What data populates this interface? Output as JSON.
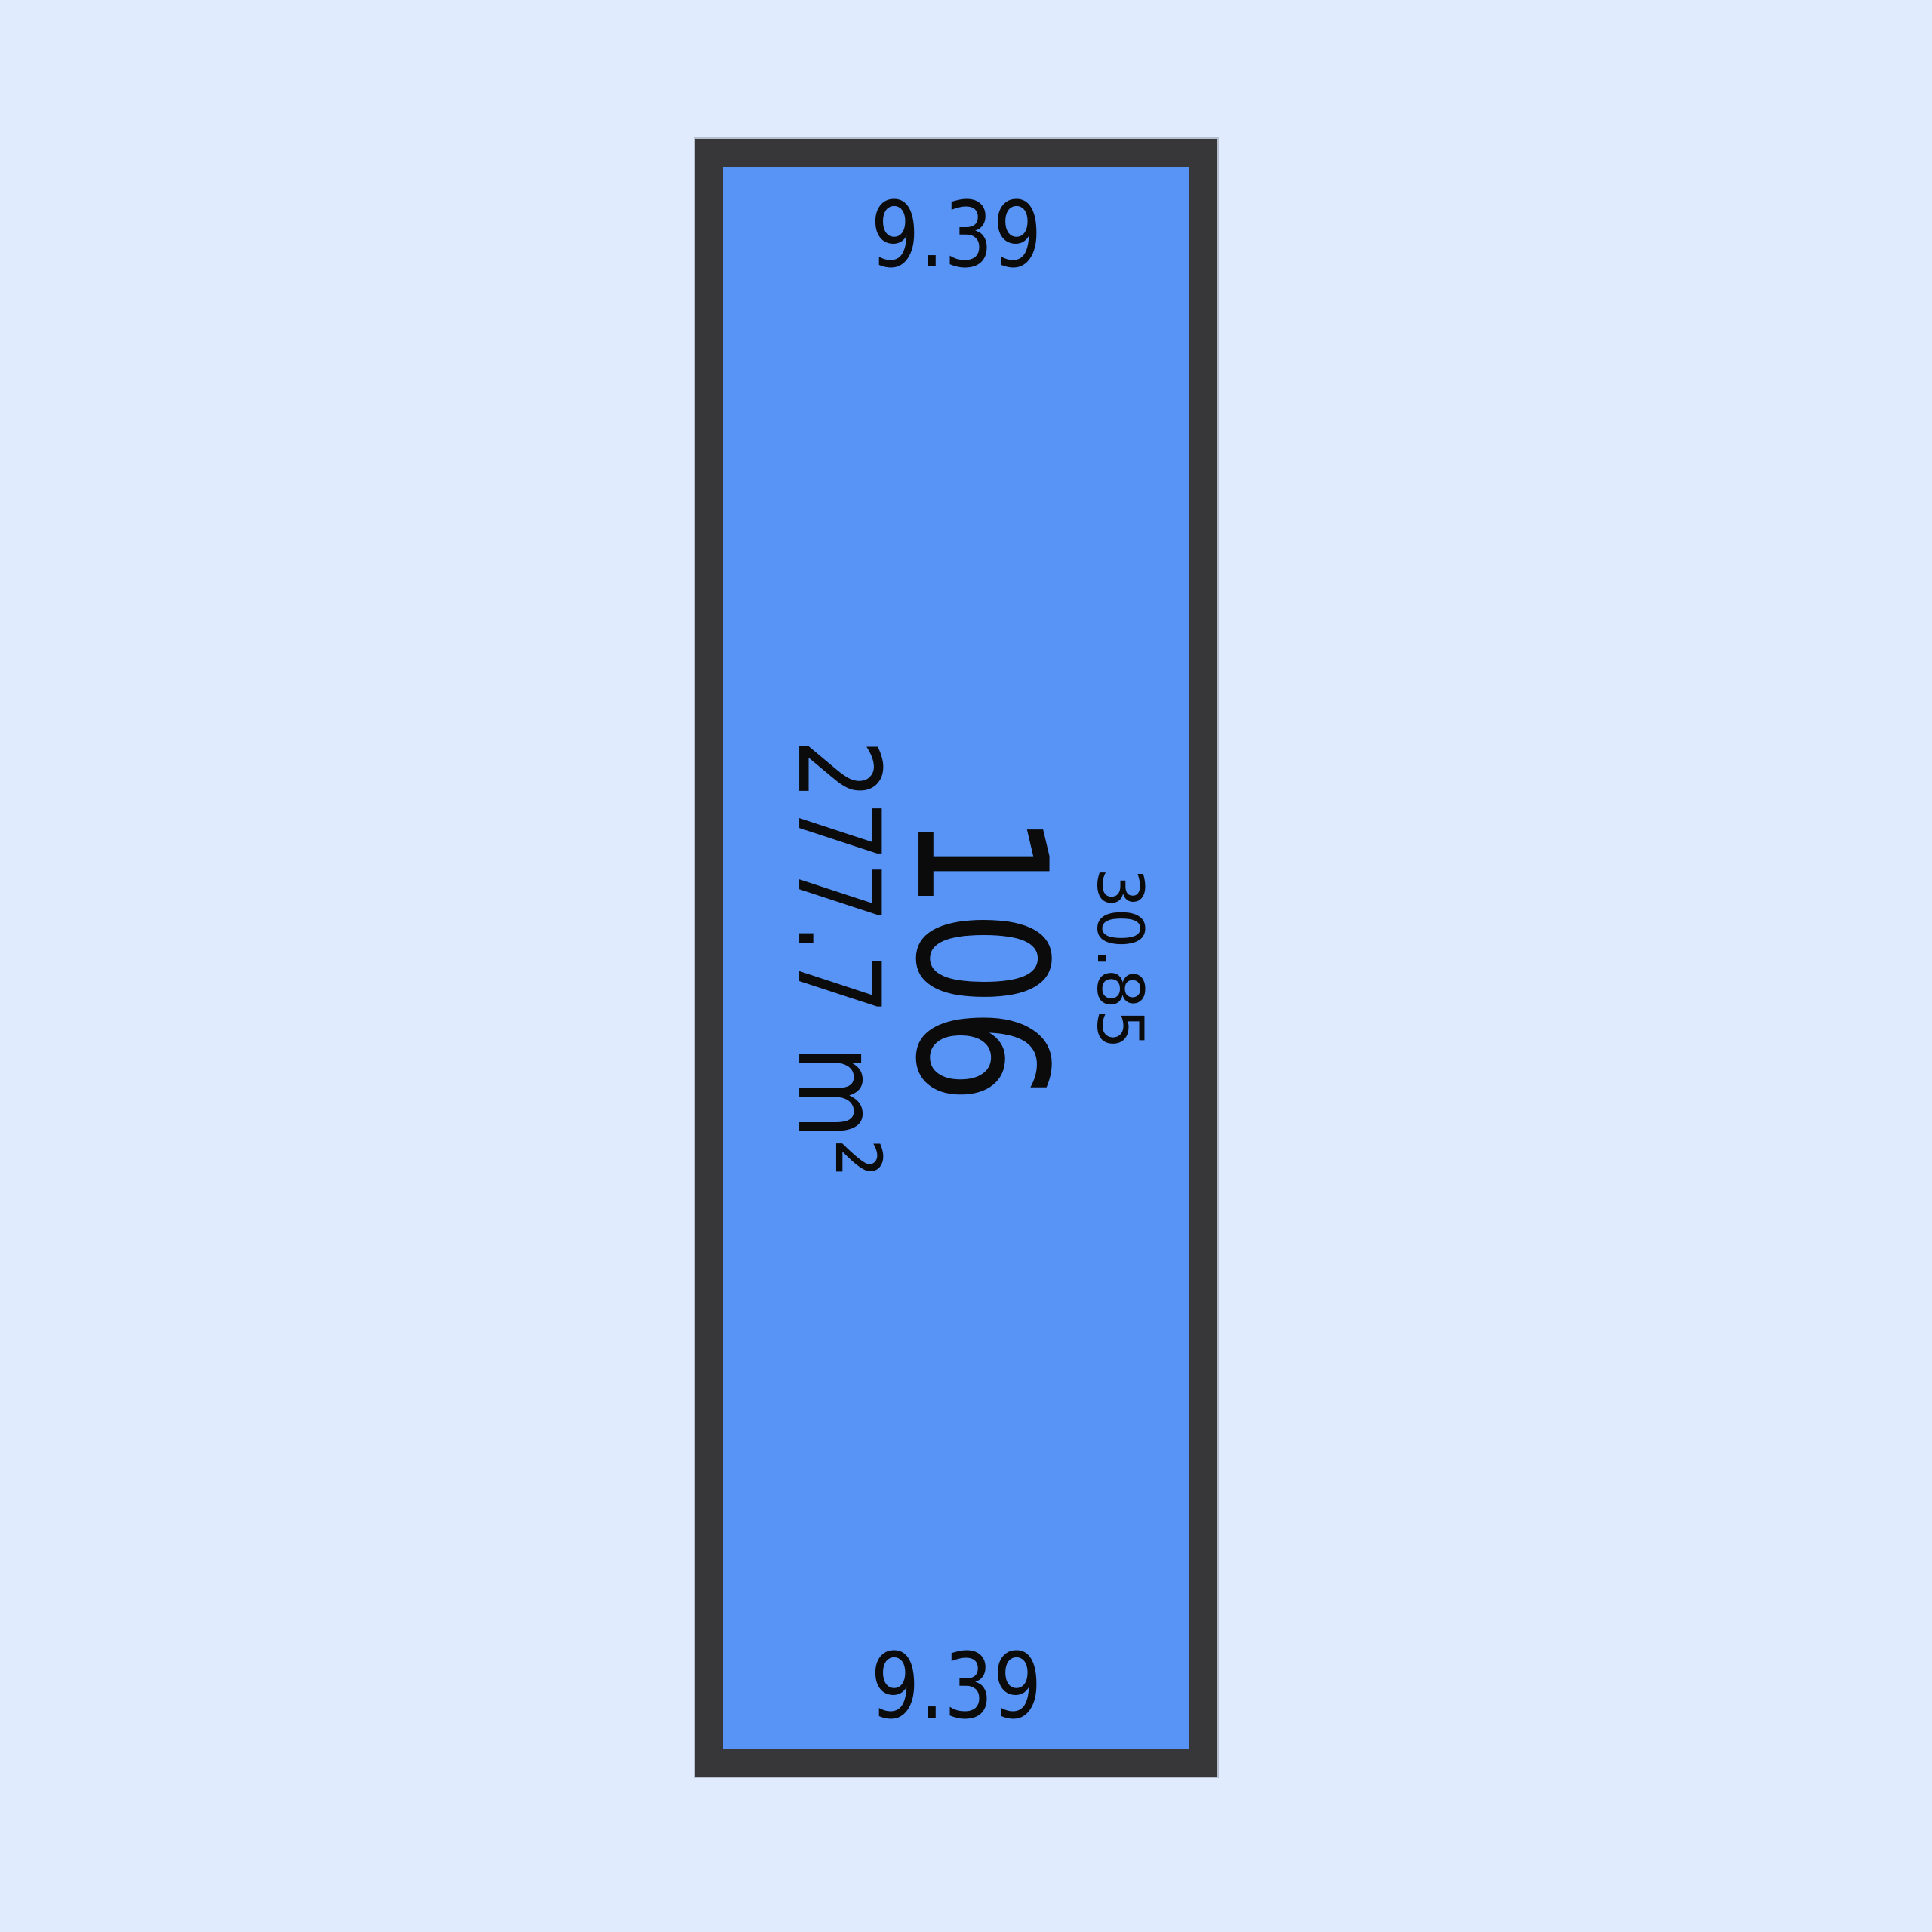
{
  "page": {
    "background_color": "#e0ecfd"
  },
  "lot": {
    "number": "106",
    "area": "277.7 m²",
    "dimensions": {
      "top": "9.39",
      "bottom": "9.39",
      "right_side": "30.85"
    },
    "fill_color": "#5894f6",
    "outline_color": "#37373a",
    "text_color": "#0b0b0c"
  }
}
